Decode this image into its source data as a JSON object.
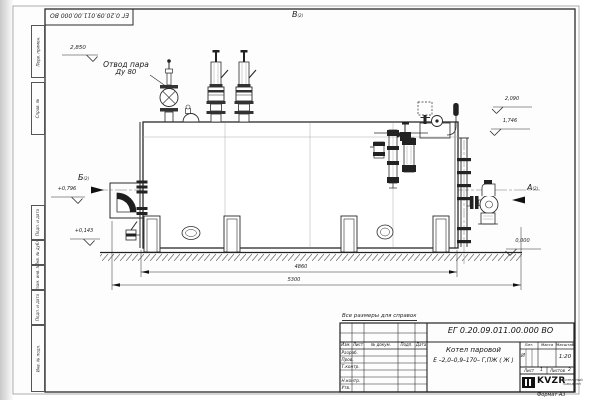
{
  "sheet": {
    "doc_number": "ЕГ 0.20.09.011.00.000  ВО",
    "note_reference": "Все размеры для справок",
    "format_label": "Формат А3"
  },
  "drawing": {
    "steam_outlet_label_line1": "Отвод пара",
    "steam_outlet_label_line2": "Ду 80",
    "views": {
      "a": "А",
      "b": "Б",
      "v": "В",
      "sheet_ref": "(2)"
    },
    "elevations": {
      "valves_top": "2,850",
      "dome_top": "2,090",
      "shell_top": "1,746",
      "burner_axis": "+0,796",
      "base": "+0,143",
      "ground": "0,000"
    },
    "dimensions": {
      "boiler_length": "4860",
      "overall_length": "5300"
    }
  },
  "title_block": {
    "product_line1": "Котел паровой",
    "product_line2": "Е –2,0–0,9–170– Г,ПЖ ( Ж )",
    "col_izm": "Изм.",
    "col_list": "Лист",
    "col_ndoc": "№ докум.",
    "col_podp": "Подп.",
    "col_data": "Дата",
    "row_razrab": "Разраб.",
    "row_prov": "Пров.",
    "row_tkontr": "Т.контр.",
    "row_nkontr": "Н.контр.",
    "row_utv": "Утв.",
    "lit_header": "Лит.",
    "mass_header": "Масса",
    "scale_header": "Масштаб",
    "lit_value": "И",
    "scale_value": "1:20",
    "sheet_label": "Лист",
    "sheet_value": "1",
    "sheets_label": "Листов",
    "sheets_value": "2",
    "logo_text": "KVZR",
    "logo_caption_line1": "КОТЕЛЬНЫЙ",
    "logo_caption_line2": "ЗАВОД РЭП"
  },
  "margin": {
    "boxes": [
      "Перв. примен.",
      "Справ. №",
      "Подп. и дата",
      "Инв. № дубл.",
      "Взам. инв. №",
      "Подп. и дата",
      "Инв. № подл."
    ]
  }
}
